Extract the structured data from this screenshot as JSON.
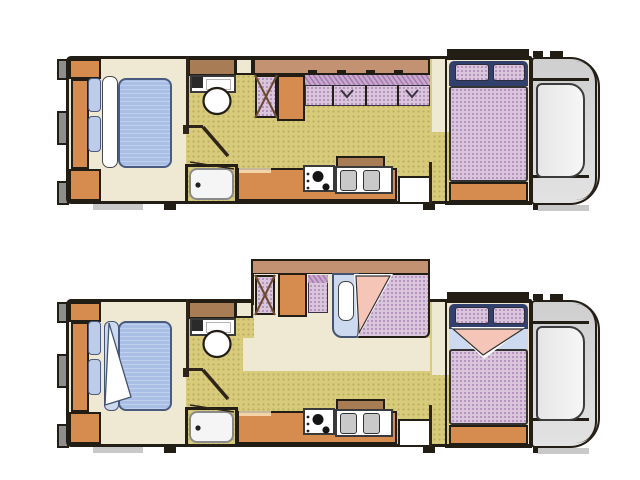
{
  "canvas": {
    "width": 640,
    "height": 480,
    "background": "#ffffff"
  },
  "palette": {
    "outline": "#221d15",
    "wall-brown": "#2e2418",
    "bumper-gray": "#8e8e8e",
    "step-gray": "#c9c9c9",
    "floor-cream": "#efe8d3",
    "floor-olive": "#d8cb7c",
    "cabinet-orange": "#d68c4e",
    "shelf-brown": "#a87c54",
    "slide-brown": "#c39272",
    "mattress-pink": "#d9c5dc",
    "hatch-purple": "#c9a9ce",
    "bed-blue": "#a9bfe5",
    "pillow-blue": "#bccce9",
    "sheet-blue": "#cdd9ee",
    "blanket-pink": "#f5c6b8",
    "navy": "#32406d",
    "cab-gray": "#cfcfcf",
    "windshield-gray": "#f6f6f6",
    "basin-gray": "#c9c9c9"
  },
  "floorplans": [
    {
      "id": "floorplan-top",
      "position": "top",
      "slide_out": "retracted",
      "sofa": "seating",
      "beds": "made",
      "rooms": [
        "rear-bedroom",
        "bathroom",
        "shower",
        "wardrobe",
        "sofa-dinette",
        "galley-kitchen",
        "entry-step",
        "cab-over-bed",
        "driver-cab"
      ]
    },
    {
      "id": "floorplan-bottom",
      "position": "bottom",
      "slide_out": "extended",
      "sofa": "converted-to-bed",
      "beds": "turned-down",
      "rooms": [
        "rear-bedroom",
        "bathroom",
        "shower",
        "wardrobe",
        "sofa-bed",
        "galley-kitchen",
        "entry-step",
        "cab-over-bed",
        "driver-cab"
      ]
    }
  ]
}
